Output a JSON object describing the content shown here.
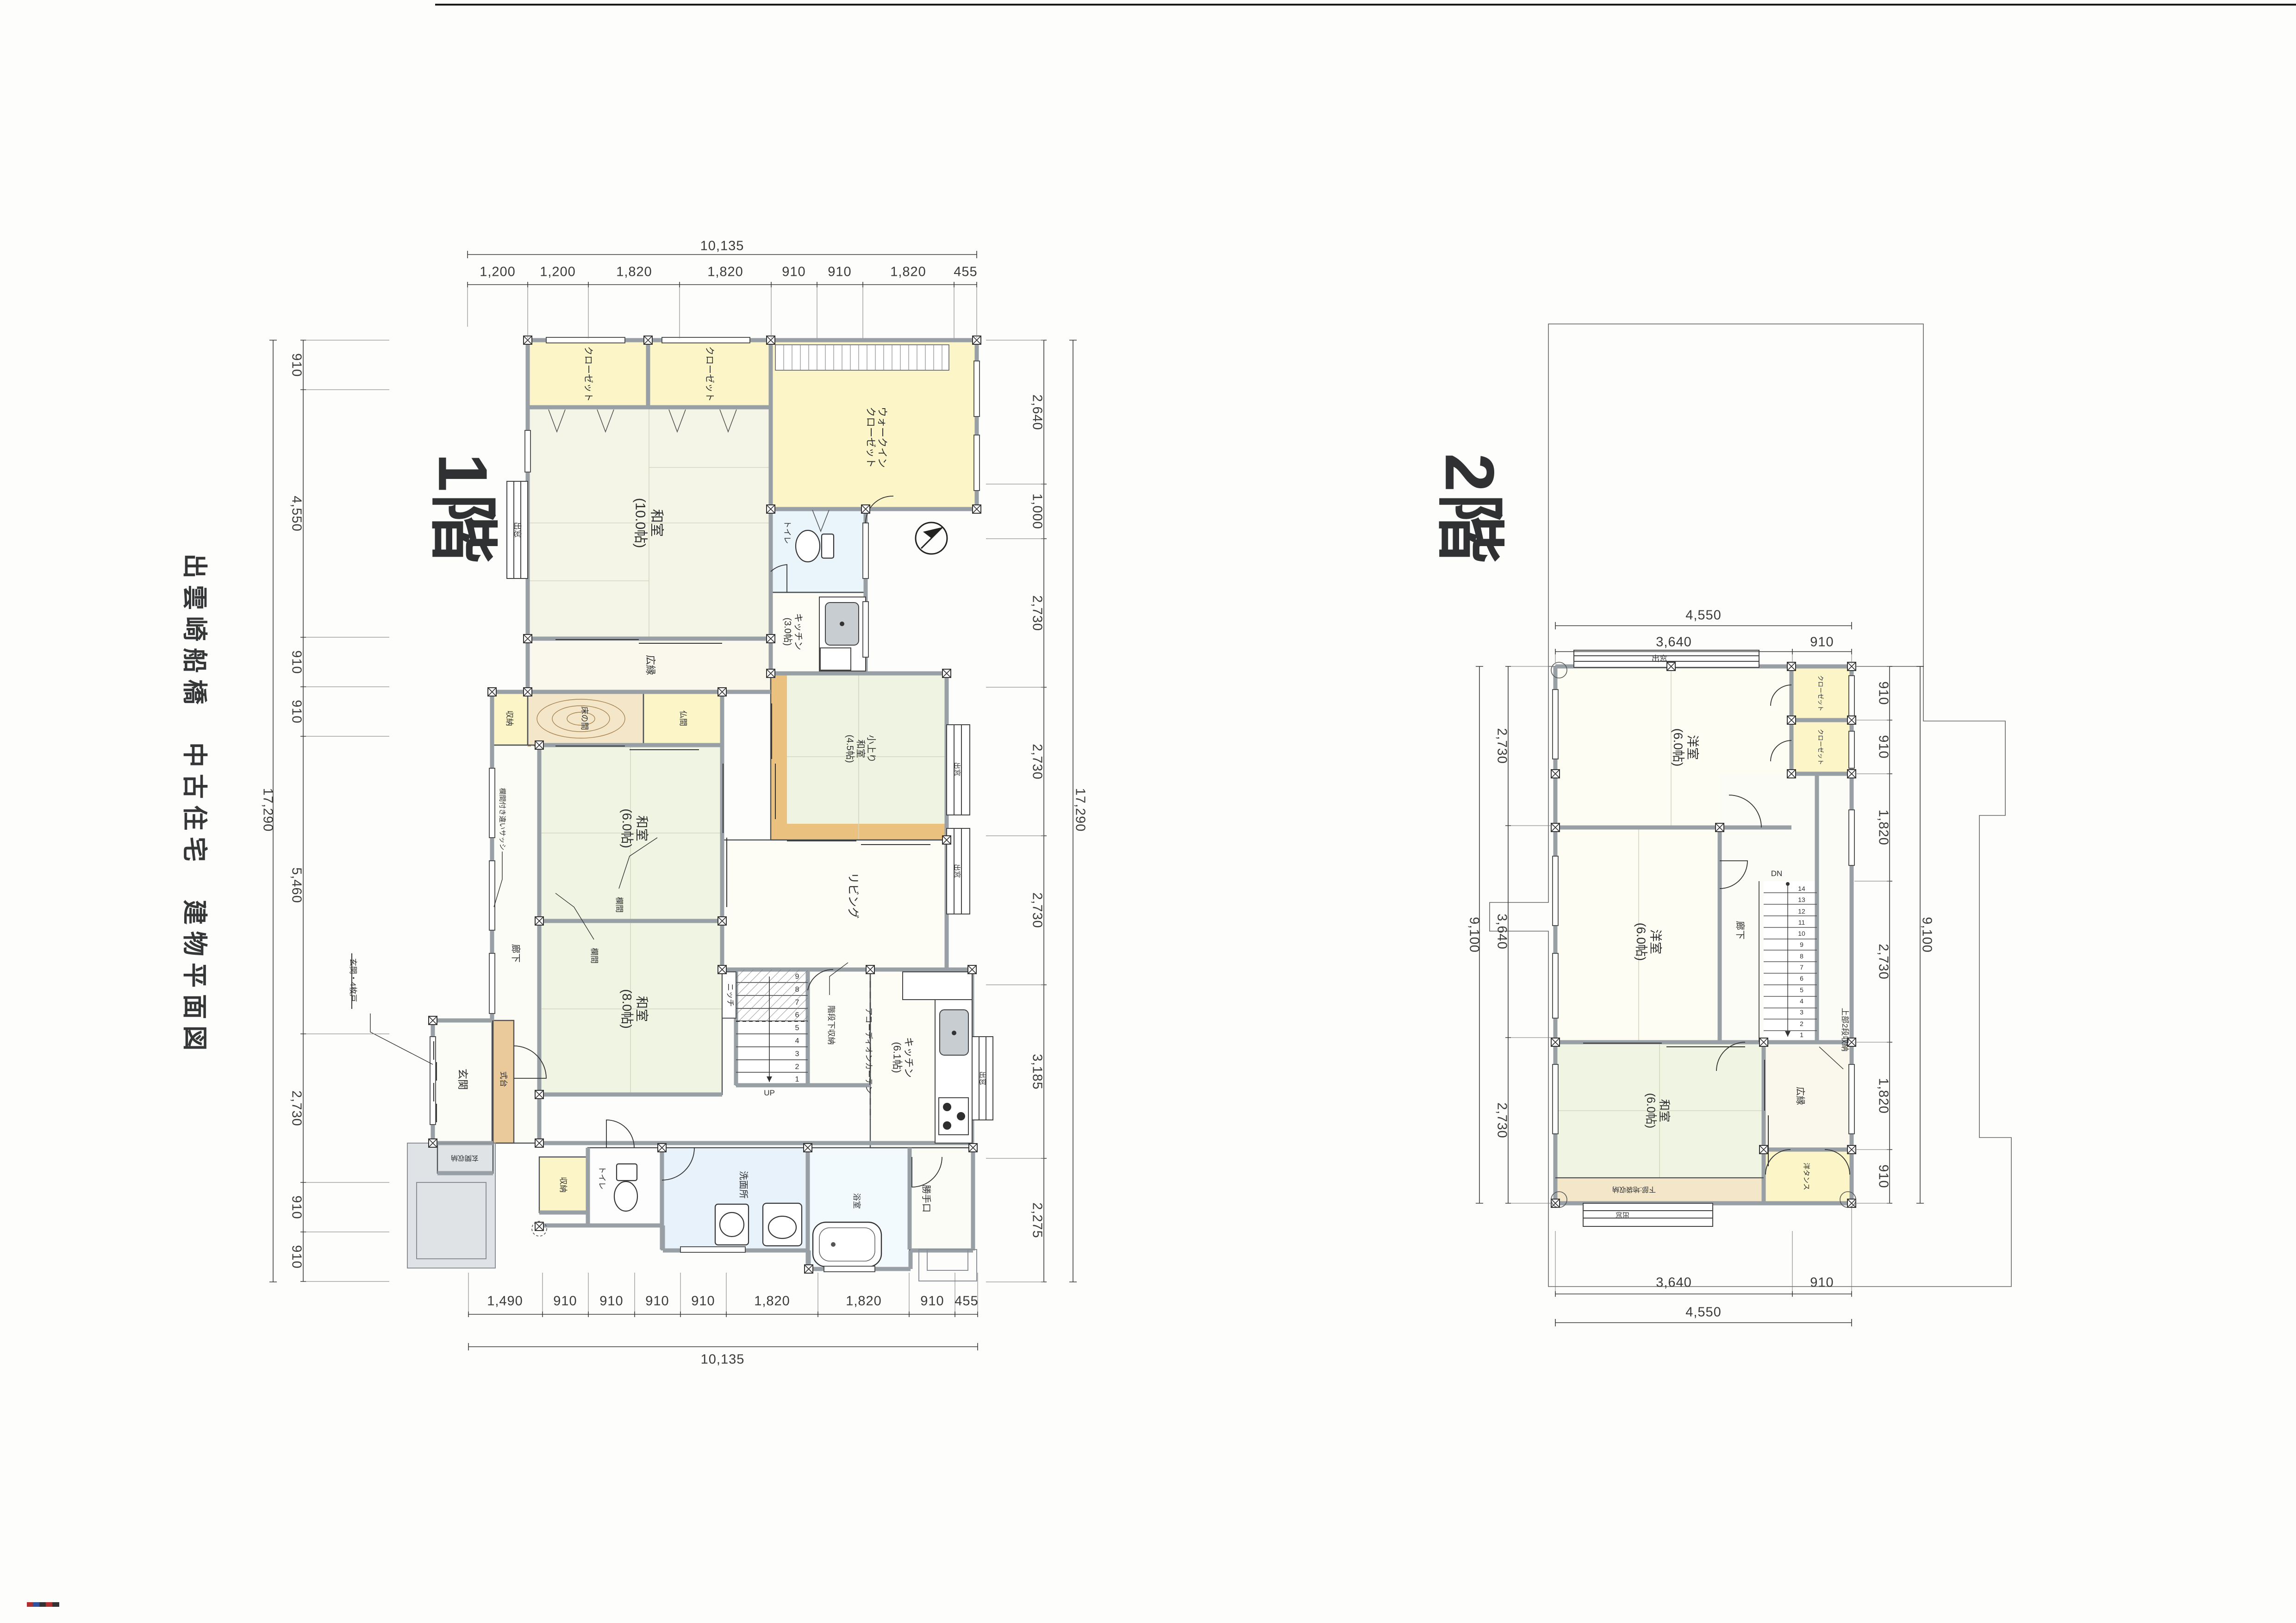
{
  "page": {
    "title_block": "出雲崎船橋　中古住宅　建物平面図"
  },
  "floor1": {
    "label": "1階",
    "dims": {
      "top": {
        "total": "10,135",
        "segments": [
          "1,200",
          "1,200",
          "1,820",
          "1,820",
          "910",
          "910",
          "1,820",
          "455"
        ]
      },
      "bottom": {
        "total": "10,135",
        "segments": [
          "1,490",
          "910",
          "910",
          "910",
          "910",
          "1,820",
          "1,820",
          "910",
          "455"
        ]
      },
      "left": {
        "total": "17,290",
        "segments": [
          "910",
          "4,550",
          "910",
          "910",
          "5,460",
          "2,730",
          "910",
          "910"
        ]
      },
      "right": {
        "total": "17,290",
        "segments": [
          "2,640",
          "1,000",
          "2,730",
          "2,730",
          "2,730",
          "3,185",
          "2,275"
        ]
      }
    },
    "rooms": {
      "closet1": "クローゼット",
      "closet2": "クローゼット",
      "wic": "ウォークイン\nクローゼット",
      "washitsu10": "和室\n(10.0帖)",
      "demado_left": "出窓",
      "toilet_top": "トイレ",
      "kitchen3": "キッチン\n(3.0帖)",
      "hiroen": "広縁",
      "shuno_mid": "収納",
      "tokonoma": "床の間",
      "butsuma": "仏間",
      "washitsu6": "和室\n(6.0帖)",
      "washitsu8": "和室\n(8.0帖)",
      "ranma1": "欄間",
      "ranma2": "欄間",
      "ranma_sash": "欄間付き違いサッシ",
      "rouka": "廊下",
      "niche": "ニッチ",
      "up": "UP",
      "stair_numbers": "9\n8\n7\n6\n5\n4\n3\n2\n1",
      "kaidan_shuno": "階段下収納",
      "accordion": "アコーディオンカーテン",
      "kitchen61": "キッチン\n(6.1帖)",
      "demado_kitchen": "出窓",
      "living": "リビング",
      "koagari": "小上り\n和室\n(4.5帖)",
      "demado_living1": "出窓",
      "demado_living2": "出窓",
      "genkan": "玄関",
      "shikidai": "式台",
      "genkan_shuno": "玄関収納",
      "genkan_door": "玄関・4枚戸",
      "shuno_btm": "収納",
      "toilet_btm": "トイレ",
      "senmenjo": "洗面所",
      "yokushitsu": "浴室",
      "katteguchi": "勝手口"
    }
  },
  "floor2": {
    "label": "2階",
    "dims": {
      "top": {
        "total": "4,550",
        "segments": [
          "3,640",
          "910"
        ]
      },
      "bottom": {
        "total": "4,550",
        "segments": [
          "3,640",
          "910"
        ]
      },
      "left": {
        "total": "9,100",
        "segments": [
          "2,730",
          "3,640",
          "2,730"
        ]
      },
      "right": {
        "total": "9,100",
        "segments": [
          "910",
          "910",
          "1,820",
          "2,730",
          "1,820",
          "910"
        ]
      }
    },
    "rooms": {
      "demado_top": "出窓",
      "yoshitsuA": "洋室\n(6.0帖)",
      "closetA": "クローゼット",
      "closetB": "クローゼット",
      "yoshitsuB": "洋室\n(6.0帖)",
      "rouka": "廊下",
      "dn": "DN",
      "stair_numbers": "14\n13\n12\n11\n10\n9\n8\n7\n6\n5\n4\n3\n2\n1",
      "jobu": "上部2段収納",
      "hiroen": "広縁",
      "washitsu6": "和室\n(6.0帖)",
      "yotansu": "洋タンス",
      "kabu": "下部:地袋収納",
      "demado_btm": "出窓"
    }
  }
}
